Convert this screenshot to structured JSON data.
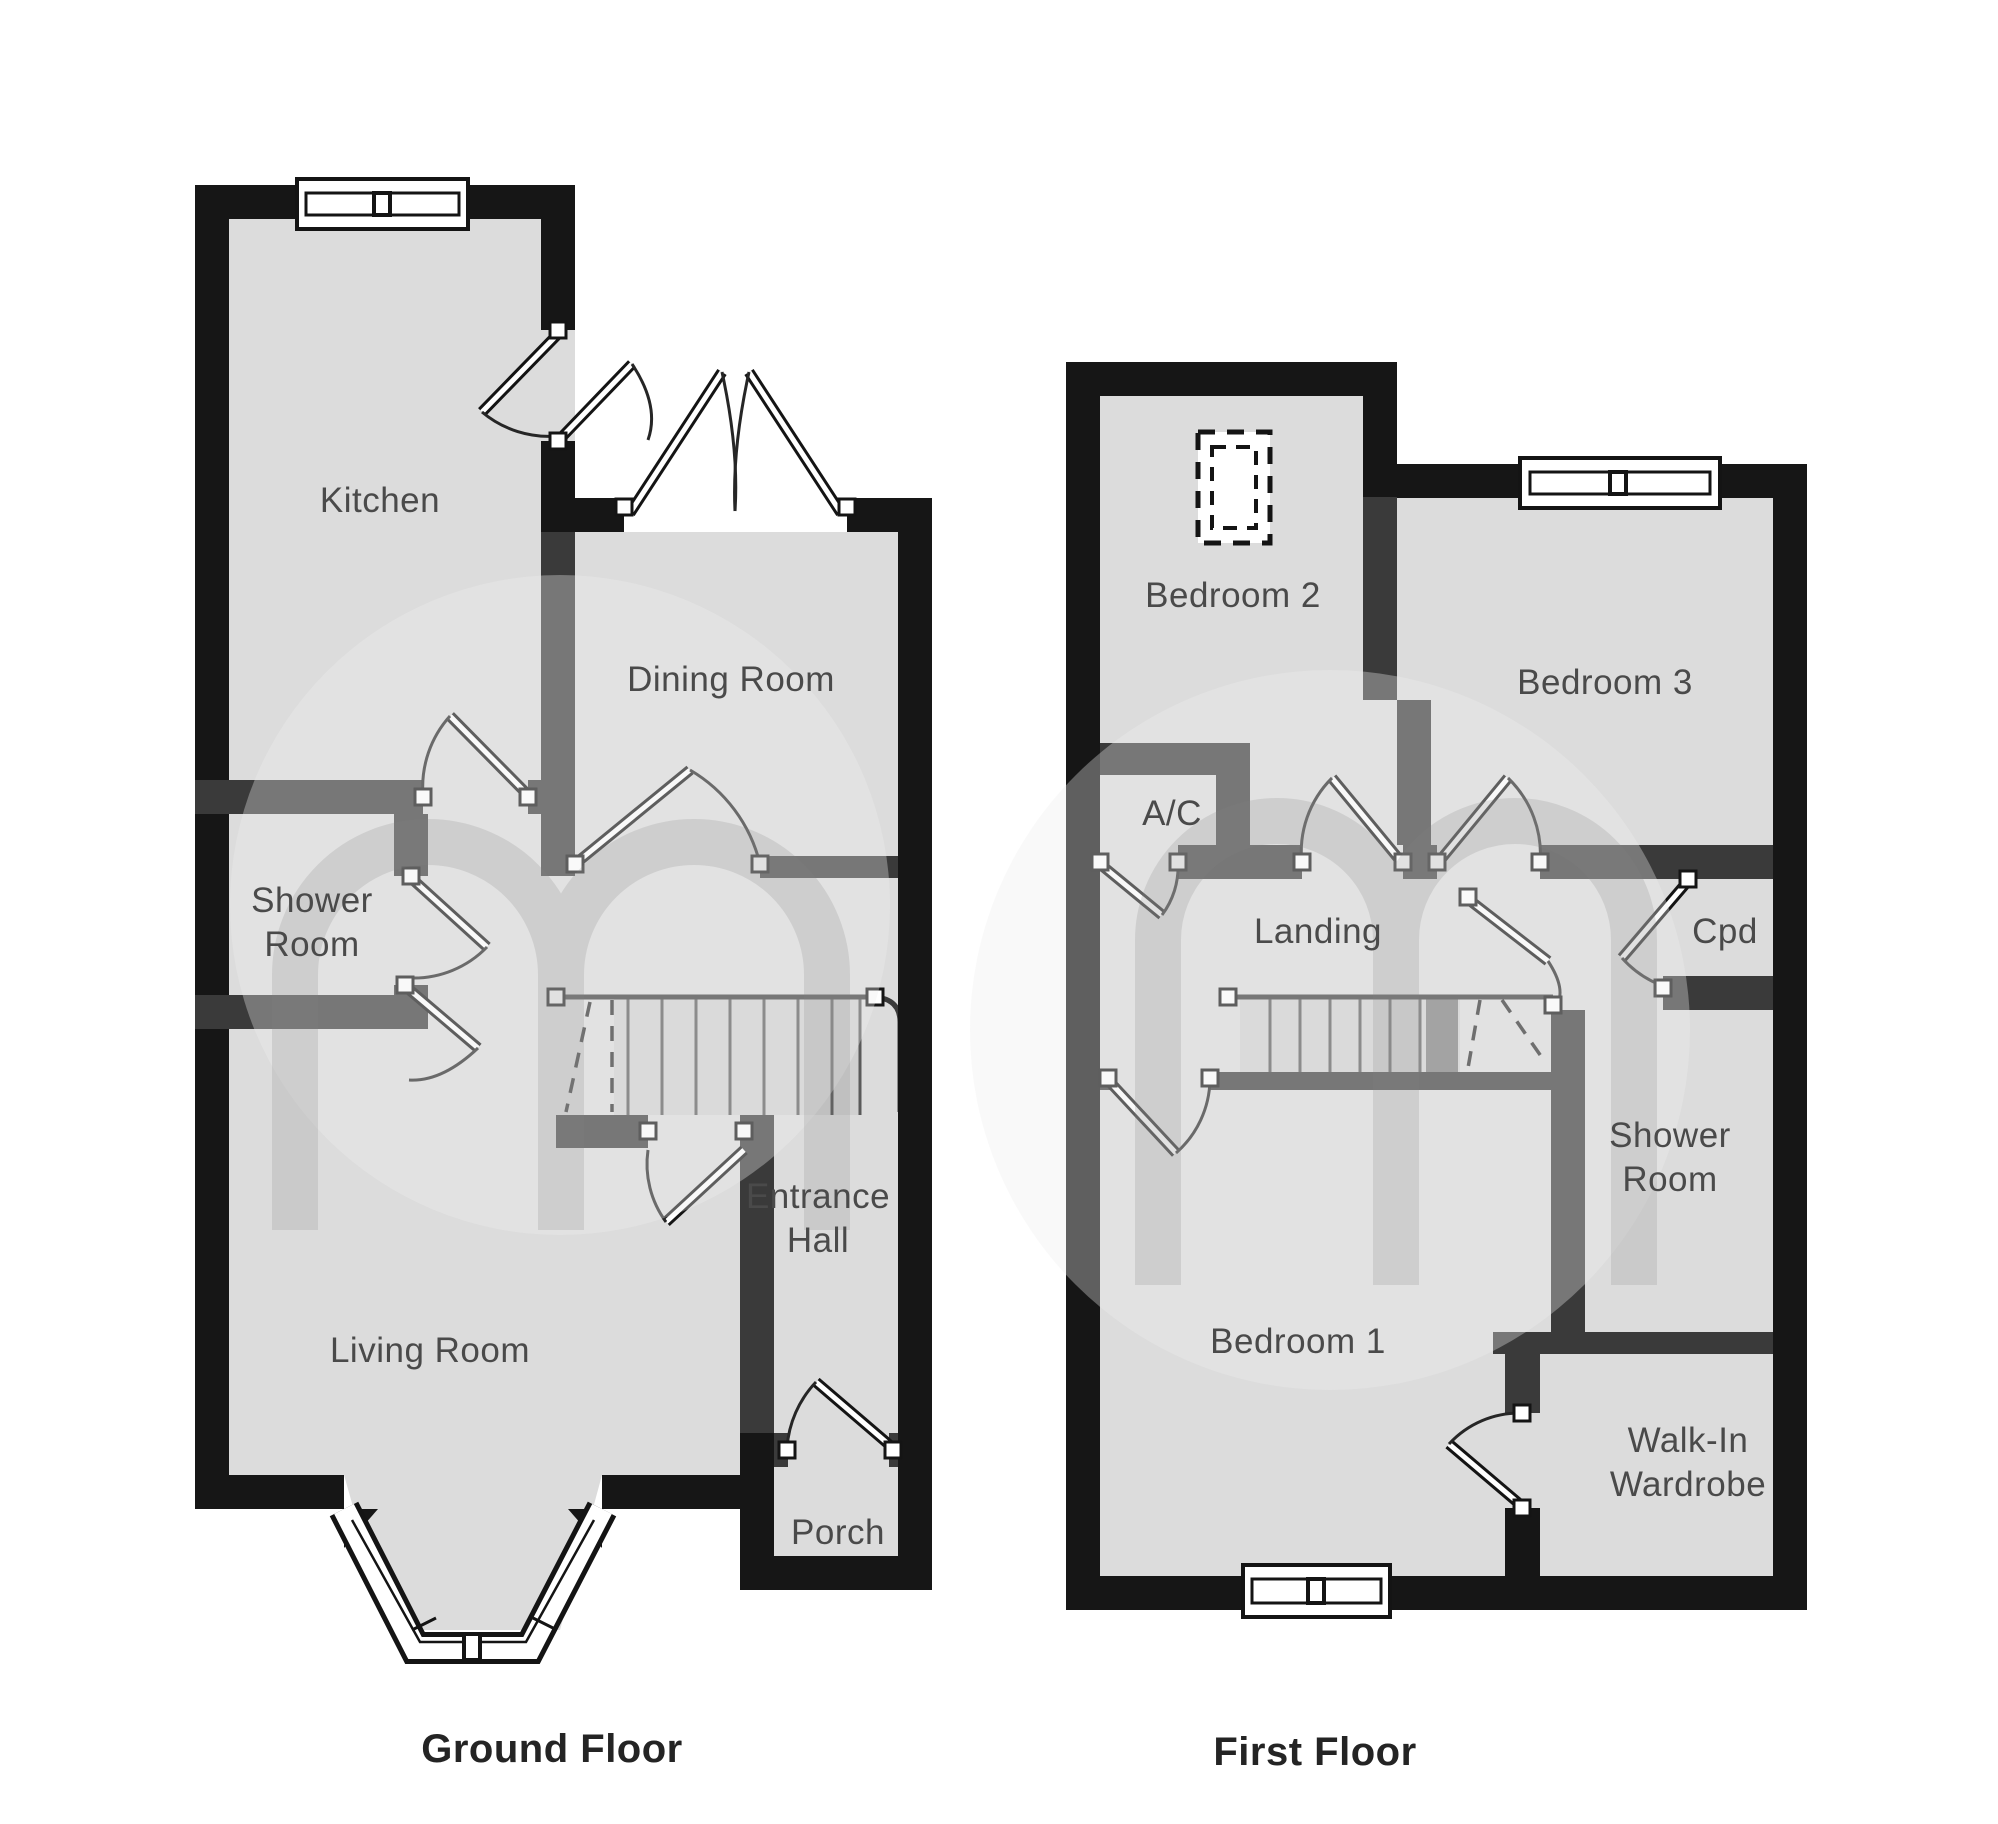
{
  "document": {
    "type": "floorplan",
    "watermark_letter": "m"
  },
  "colors": {
    "floor_fill": "#dcdcdc",
    "exterior_wall": "#161616",
    "interior_wall": "#3a3a3a",
    "label_text": "#4a4a4a",
    "caption_text": "#242424",
    "background": "#ffffff"
  },
  "floors": [
    {
      "id": "ground",
      "caption": "Ground Floor",
      "caption_x": 552,
      "caption_y": 1762,
      "rooms": [
        {
          "id": "kitchen",
          "label": [
            "Kitchen"
          ],
          "x": 380,
          "y": 512
        },
        {
          "id": "dining-room",
          "label": [
            "Dining Room"
          ],
          "x": 731,
          "y": 691
        },
        {
          "id": "shower-room",
          "label": [
            "Shower",
            "Room"
          ],
          "x": 312,
          "y": 912
        },
        {
          "id": "entrance-hall",
          "label": [
            "Entrance",
            "Hall"
          ],
          "x": 818,
          "y": 1208
        },
        {
          "id": "living-room",
          "label": [
            "Living Room"
          ],
          "x": 430,
          "y": 1362
        },
        {
          "id": "porch",
          "label": [
            "Porch"
          ],
          "x": 838,
          "y": 1544
        }
      ]
    },
    {
      "id": "first",
      "caption": "First Floor",
      "caption_x": 1315,
      "caption_y": 1765,
      "rooms": [
        {
          "id": "bedroom-2",
          "label": [
            "Bedroom 2"
          ],
          "x": 1233,
          "y": 607
        },
        {
          "id": "bedroom-3",
          "label": [
            "Bedroom 3"
          ],
          "x": 1605,
          "y": 694
        },
        {
          "id": "ac-cupboard",
          "label": [
            "A/C"
          ],
          "x": 1172,
          "y": 825
        },
        {
          "id": "landing",
          "label": [
            "Landing"
          ],
          "x": 1318,
          "y": 943
        },
        {
          "id": "cpd",
          "label": [
            "Cpd"
          ],
          "x": 1725,
          "y": 943
        },
        {
          "id": "shower-room-first",
          "label": [
            "Shower",
            "Room"
          ],
          "x": 1670,
          "y": 1147
        },
        {
          "id": "bedroom-1",
          "label": [
            "Bedroom 1"
          ],
          "x": 1298,
          "y": 1353
        },
        {
          "id": "walk-in-wardrobe",
          "label": [
            "Walk-In",
            "Wardrobe"
          ],
          "x": 1688,
          "y": 1452
        }
      ]
    }
  ]
}
